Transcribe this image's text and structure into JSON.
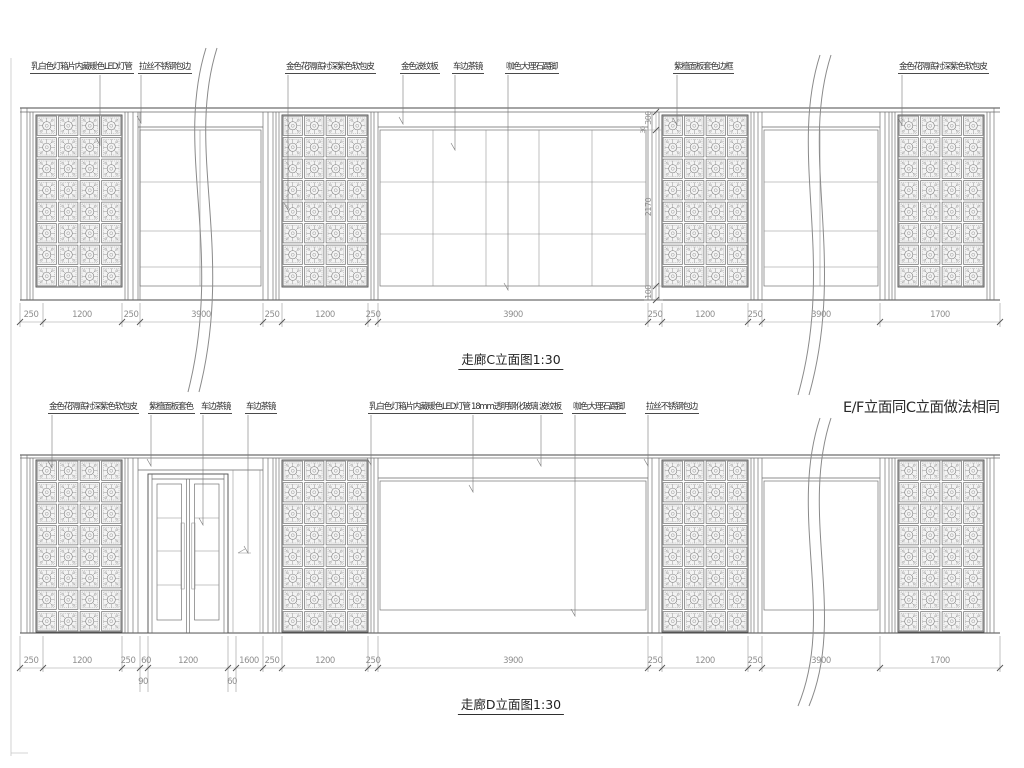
{
  "elev_c": {
    "title": "走廊C立面图1:30",
    "labels": [
      "乳白色灯箱片内藏暖色LED灯管",
      "拉丝不锈钢包边",
      "金色花隔底衬深紫色软包皮",
      "金色波纹板",
      "车边茶镜",
      "咖色大理石踢脚",
      "紫檀面板套色边框",
      "金色花隔底衬深紫色软包皮"
    ],
    "dims": [
      "250",
      "1200",
      "250",
      "3900",
      "250",
      "1200",
      "250",
      "3900",
      "250",
      "1200",
      "250",
      "3900",
      "1700"
    ],
    "dims_vertical": [
      "300",
      "30",
      "2170",
      "100"
    ]
  },
  "elev_d": {
    "title": "走廊D立面图1:30",
    "note": "E/F立面同C立面做法相同",
    "labels": [
      "金色花隔底衬深紫色软包皮",
      "紫檀面板套色",
      "车边茶镜",
      "车边茶镜",
      "乳白色灯箱片内藏暖色LED灯管",
      "18mm透明钢化玻璃",
      "波纹板",
      "咖色大理石踢脚",
      "拉丝不锈钢包边"
    ],
    "dims": [
      "250",
      "1200",
      "250",
      "60",
      "1200",
      "1600",
      "250",
      "1200",
      "250",
      "3900",
      "250",
      "1200",
      "250",
      "3900",
      "1700"
    ],
    "dims_sub": [
      "90",
      "60"
    ]
  }
}
